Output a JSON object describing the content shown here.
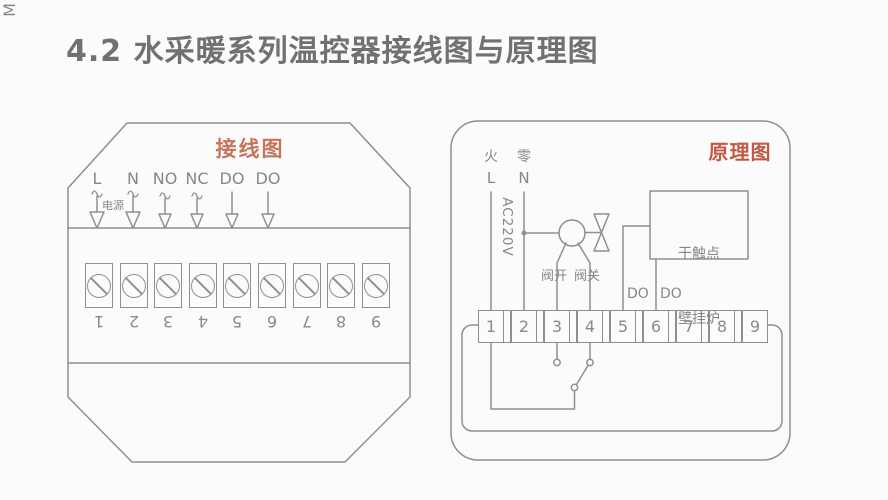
{
  "page": {
    "title": "4.2 水采暖系列温控器接线图与原理图"
  },
  "wiring_diagram": {
    "label": "接线图",
    "terminal_labels": [
      "L",
      "N",
      "NO",
      "NC",
      "DO",
      "DO"
    ],
    "power_label": "电源",
    "terminal_numbers": [
      "1",
      "2",
      "3",
      "4",
      "5",
      "6",
      "7",
      "8",
      "9"
    ]
  },
  "schematic": {
    "label": "原理图",
    "live_label": "火",
    "neutral_label": "零",
    "live_letter": "L",
    "neutral_letter": "N",
    "voltage_label": "AC220V",
    "motor_label": "M",
    "valve_open_label": "阀开",
    "valve_close_label": "阀关",
    "do_labels": [
      "DO",
      "DO"
    ],
    "boiler_box_line1": "干触点",
    "boiler_box_line2": "壁挂炉",
    "terminal_numbers": [
      "1",
      "2",
      "3",
      "4",
      "5",
      "6",
      "7",
      "8",
      "9"
    ]
  },
  "colors": {
    "accent_wiring_label": "#c4755a",
    "accent_schematic_label": "#bf5a46",
    "line_gray": "#8f8f8f",
    "text_gray": "#878787",
    "title_gray": "#717171",
    "background": "#fbfbfb"
  }
}
